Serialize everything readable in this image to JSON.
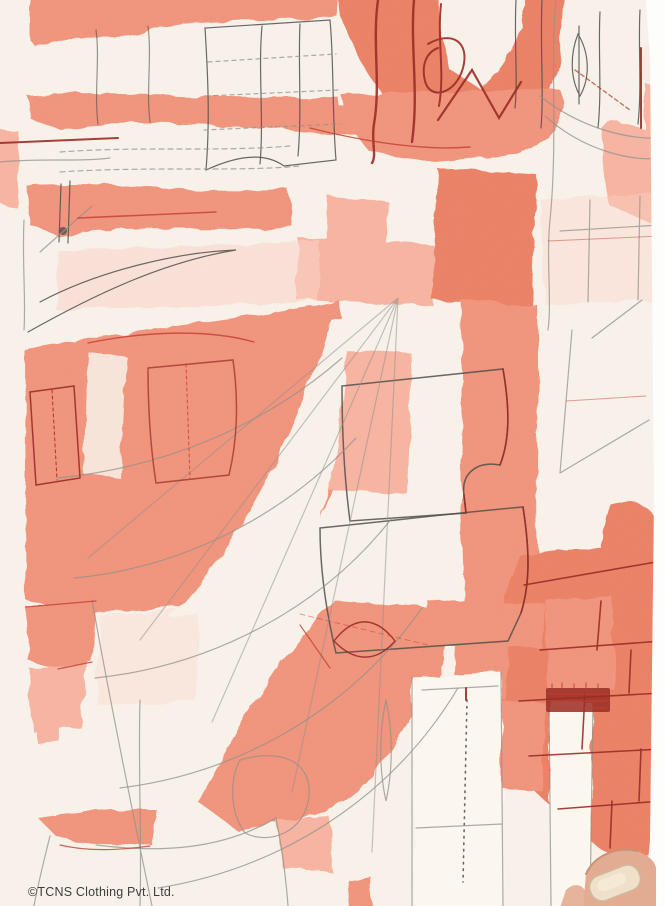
{
  "image": {
    "type": "product-photo",
    "subject": "fabric close-up with abstract coral sewing-pattern print",
    "alt": "Close-up of off-white fabric printed with coral patches and dark sketched sewing-pattern lines; a thumb holds the fabric edge at the bottom right"
  },
  "watermark": {
    "text": "©TCNS Clothing Pvt. Ltd."
  },
  "palette": {
    "background_cream": "#f8f1e9",
    "panel_cream": "#fbf6ee",
    "coral": "#f0927a",
    "coral_deep": "#ea7f64",
    "coral_light": "#f6b29f",
    "coral_wash": "#f9d3c6",
    "ink": "#4c4a47",
    "ink_light": "#8f8d88",
    "marker_red": "#97271f",
    "marker_red_bright": "#bf3a2a",
    "skin": "#e2aa8f",
    "skin_shadow": "#c68f72",
    "nail": "#efdfc9",
    "photo_edge_white": "#fdfdfb",
    "watermark_color": "#3e3e3e"
  }
}
